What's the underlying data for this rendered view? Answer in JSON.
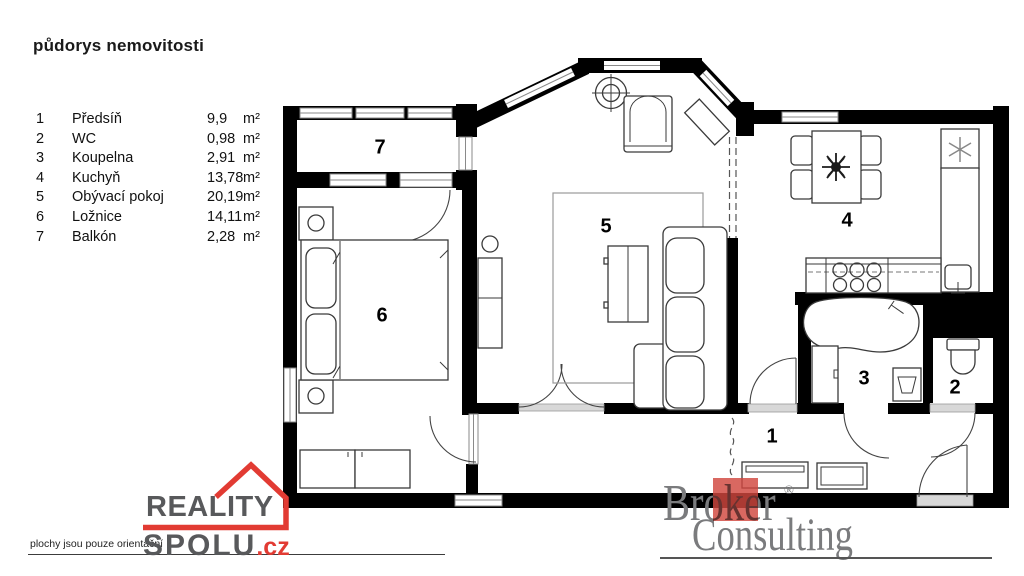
{
  "title": "půdorys nemovitosti",
  "legend": {
    "items": [
      {
        "num": "1",
        "name": "Předsíň",
        "area": "9,9",
        "unit": "m²"
      },
      {
        "num": "2",
        "name": "WC",
        "area": "0,98",
        "unit": "m²"
      },
      {
        "num": "3",
        "name": "Koupelna",
        "area": "2,91",
        "unit": "m²"
      },
      {
        "num": "4",
        "name": "Kuchyň",
        "area": "13,78",
        "unit": "m²"
      },
      {
        "num": "5",
        "name": "Obývací pokoj",
        "area": "20,19",
        "unit": "m²"
      },
      {
        "num": "6",
        "name": "Ložnice",
        "area": "14,11",
        "unit": "m²"
      },
      {
        "num": "7",
        "name": "Balkón",
        "area": "2,28",
        "unit": "m²"
      }
    ]
  },
  "plan": {
    "room_numbers": [
      {
        "label": "1"
      },
      {
        "label": "2"
      },
      {
        "label": "3"
      },
      {
        "label": "4"
      },
      {
        "label": "5"
      },
      {
        "label": "6"
      },
      {
        "label": "7"
      }
    ]
  },
  "footer": {
    "disclaimer": "plochy jsou pouze orientační",
    "reality_logo": {
      "word1": "REALITY",
      "word2": "SPOLU",
      "tld": ".cz"
    },
    "broker_logo": {
      "word1": "Broker",
      "reg": "®",
      "word2": "Consulting"
    }
  },
  "colors": {
    "accent_red": "#e23b33",
    "logo_gray": "#58595b",
    "broker_gray": "#7a7b7d",
    "wall_black": "#000000"
  }
}
